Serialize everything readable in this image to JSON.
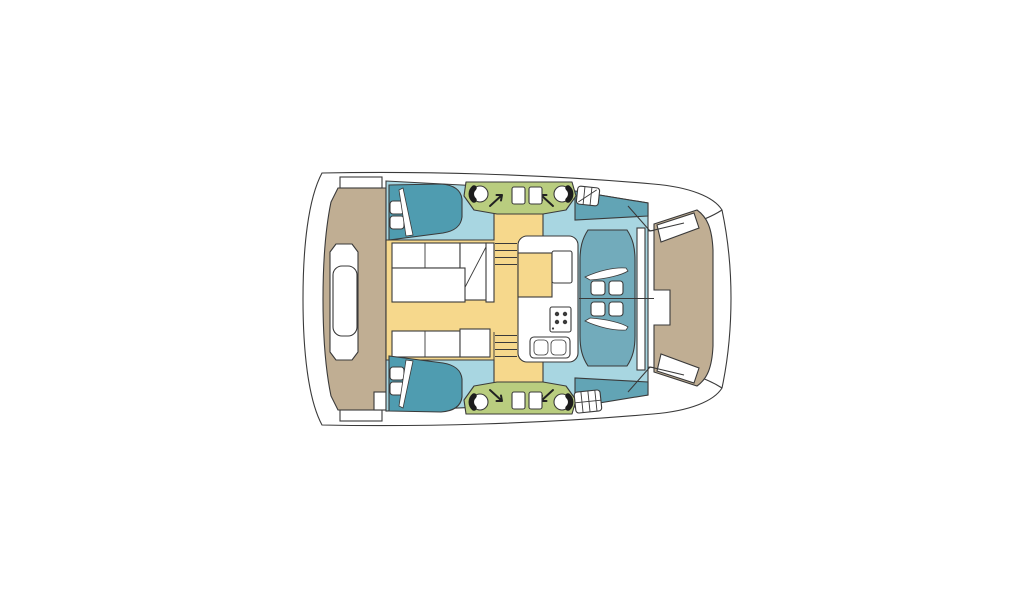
{
  "image": {
    "width": 1024,
    "height": 600,
    "type": "floor-plan",
    "subject": "catamaran yacht deck layout, top view, bows to the right",
    "background": "#ffffff"
  },
  "palette": {
    "hull_white": "#ffffff",
    "outline": "#3a3a3a",
    "floor_blue": "#a8d6e1",
    "bed_teal": "#4f9cb0",
    "berth_teal": "#62a4b5",
    "lounge_teal": "#72abbb",
    "salon_yellow": "#f6d88c",
    "cockpit_green": "#b9cd7f",
    "deck_tan": "#c0ae93",
    "chair_black": "#1d1d1d",
    "burner_dark": "#3a3a3a"
  },
  "features": {
    "hulls": 2,
    "double_beds": 2,
    "pillows_per_bed": 2,
    "swivel_chairs": [
      {
        "position": "top-left",
        "arrow": "↗"
      },
      {
        "position": "top-right",
        "arrow": "↖"
      },
      {
        "position": "bottom-left",
        "arrow": "↘"
      },
      {
        "position": "bottom-right",
        "arrow": "↙"
      }
    ],
    "cockpit_jump_seats": 4,
    "companionway_steps_per_stair": 4,
    "stove_burners": 4,
    "sink_bowls": 2,
    "bow_lounge_cushions": 4,
    "deck_hatches": 2
  }
}
